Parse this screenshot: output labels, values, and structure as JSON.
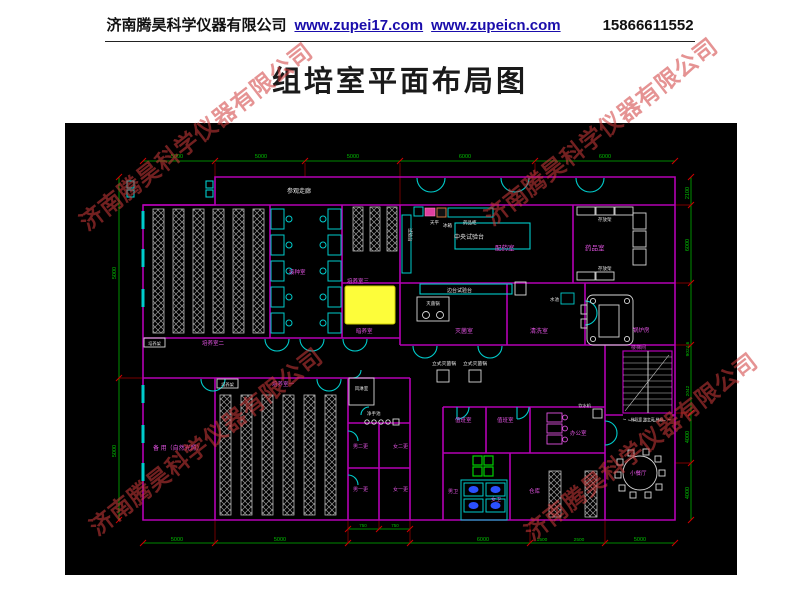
{
  "header": {
    "company": "济南腾昊科学仪器有限公司",
    "url1": "www.zupei17.com",
    "url2": "www.zupeicn.com",
    "phone": "15866611552"
  },
  "title": "组培室平面布局图",
  "watermark": {
    "text": "济南腾昊科学仪器有限公司",
    "color": "#d03a3a"
  },
  "colors": {
    "canvas_bg": "#000000",
    "wall": "#b400b4",
    "door": "#00cccc",
    "dim_line": "#00c000",
    "dim_tick": "#d00000",
    "room_label": "#e052e0",
    "furniture": "#c8c8c8",
    "highlight": "#fdfd3a",
    "toilet_fixture": "#2b50ff",
    "stall": "#00d000",
    "fridge_fill": "#e040a0"
  },
  "plan": {
    "corridor_label": "参观走廊",
    "rooms": {
      "culture1": "培养室一",
      "culture2": "培养室二",
      "culture3": "培养室三",
      "inoculation": "接种室",
      "dark_culture": "暗养室",
      "prep": "配药室",
      "medicine": "药品室",
      "sterilization": "灭菌室",
      "washing": "清洗室",
      "boiler": "锅炉房",
      "spare": "备 用（自然光照）",
      "air_shower": "风淋室",
      "hand_wash": "净手池",
      "male2": "男二更",
      "female2": "女二更",
      "male1": "男一更",
      "female1": "女一更",
      "duty1": "值班室",
      "duty2": "值班室",
      "male_wc": "男卫",
      "female_wc": "女卫",
      "office": "办公室",
      "storage": "仓库",
      "dining": "小餐厅",
      "stairs": "楼梯间"
    },
    "equipment": {
      "central_bench": "中央试验台",
      "side_bench": "边台试验台",
      "side_bench_v": "试验台",
      "balance": "天平",
      "fridge": "冰箱",
      "medicine_cabinet": "药品柜",
      "shelf_top": "存放架",
      "shelf_bottom": "存放架",
      "autoclave": "灭菌锅",
      "sink": "水池",
      "vertical_sterilizer1": "立式灭菌锅",
      "vertical_sterilizer2": "立式灭菌锅",
      "rack_box1": "培养架",
      "rack_box2": "培养架",
      "water_dispenser": "饮水机",
      "stairs_note": "梯段宽 踏步高 梯级"
    },
    "dims": {
      "top": [
        "5000",
        "5000",
        "5000",
        "6000",
        "6000"
      ],
      "bottom": [
        "5000",
        "5000",
        "6000",
        "1500",
        "2500",
        "5000"
      ],
      "bottom_small": [
        "750",
        "750"
      ],
      "left": [
        "5000",
        "5000"
      ],
      "right": [
        "2100",
        "6000",
        "9024.6",
        "2042",
        "4000",
        "4000"
      ]
    }
  }
}
